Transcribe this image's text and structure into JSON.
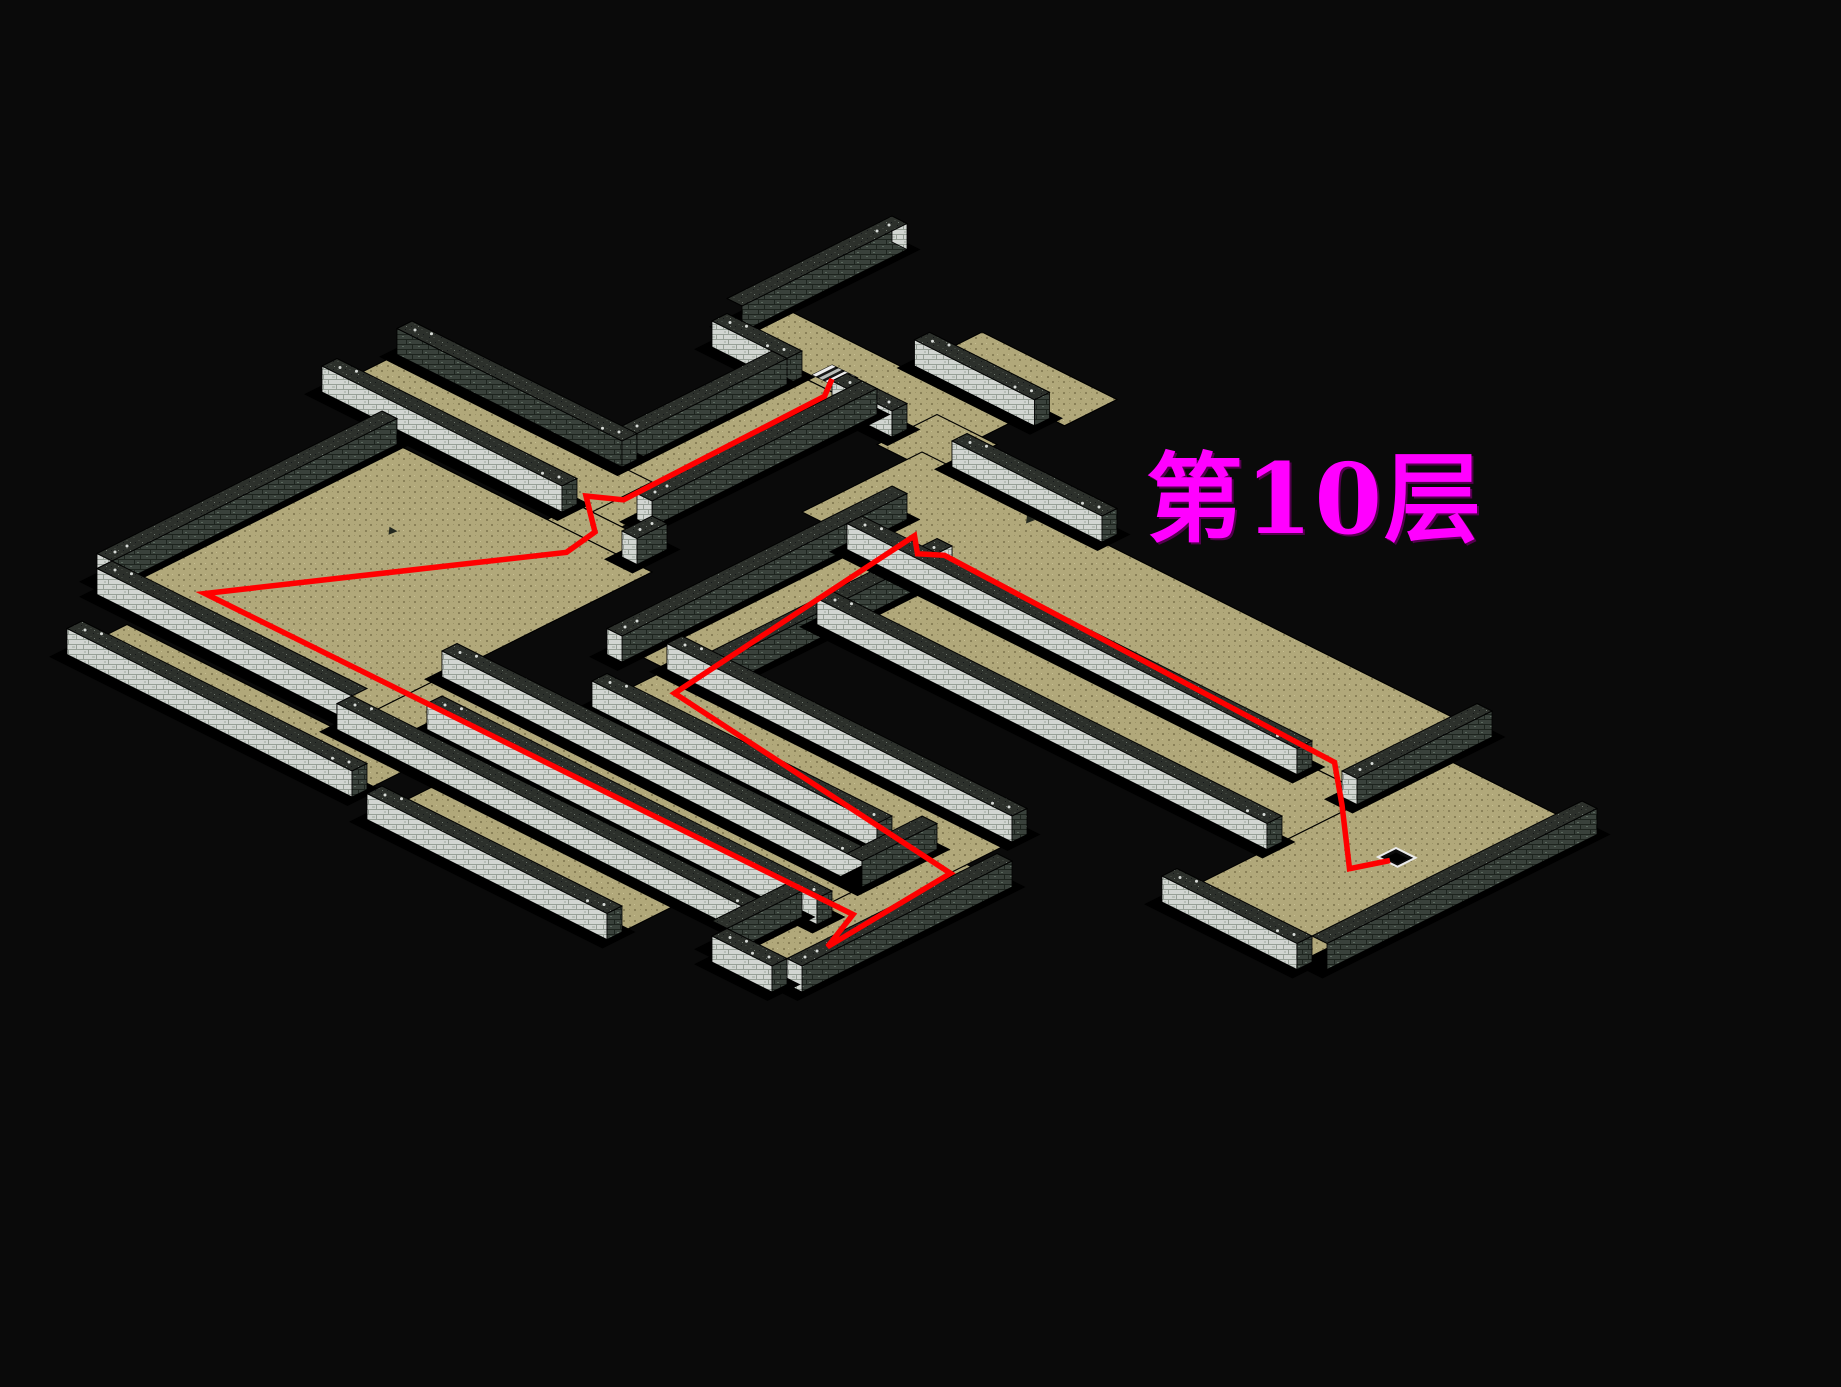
{
  "title": {
    "text": "第10层"
  },
  "colors": {
    "background": "#0a0a0a",
    "floor": "#b1a87a",
    "floorDot": "#8a8158",
    "floorDotLight": "#c8c093",
    "floorDotMid": "#9c9468",
    "wallLight": "#d2d6d2",
    "wallLightMortar": "#97a097",
    "wallLightSpeck": "#b8bfb8",
    "wallDark": "#39413b",
    "wallDarkMortar": "#1d241e",
    "wallDarkSpeck": "#5c6a5f",
    "wallTop": "#2c302b",
    "wallTopSpeck": "#3d423c",
    "wallTopSpeck2": "#15181a",
    "capDot": "#d8dcd8",
    "outline": "#000000",
    "shadow": "#000000",
    "path": "#ff0000",
    "title": "#ff00ff",
    "stairLight": "#ececec",
    "stairDark": "#161616",
    "marker": "#23281f"
  },
  "map": {
    "floors": [
      {
        "name": "corridor-top",
        "r": [
          8,
          23,
          5,
          9
        ]
      },
      {
        "name": "corridor-top-ne",
        "r": [
          16,
          25,
          0,
          3.5
        ]
      },
      {
        "name": "corridor-bend",
        "r": [
          20,
          24,
          7,
          11
        ]
      },
      {
        "name": "descender-1",
        "r": [
          13,
          17,
          9,
          25
        ]
      },
      {
        "name": "corridor-west",
        "r": [
          -2,
          15,
          21,
          25
        ]
      },
      {
        "name": "descender-2",
        "r": [
          14,
          19,
          25,
          27
        ]
      },
      {
        "name": "west-room",
        "r": [
          4,
          21,
          27,
          46
        ]
      },
      {
        "name": "south-corridor",
        "r": [
          21,
          53,
          41,
          47
        ]
      },
      {
        "name": "southwest-lane",
        "r": [
          7,
          26,
          48,
          51
        ]
      },
      {
        "name": "riser-corridor",
        "r": [
          49,
          53,
          36,
          50
        ]
      },
      {
        "name": "mid-corridor",
        "r": [
          28,
          51,
          33,
          37
        ]
      },
      {
        "name": "loop-west",
        "r": [
          26,
          30,
          15,
          33
        ]
      },
      {
        "name": "long-corridor",
        "r": [
          22,
          59,
          10,
          18
        ]
      },
      {
        "name": "long-lane-2",
        "r": [
          30,
          60,
          18,
          24
        ]
      },
      {
        "name": "east-room",
        "r": [
          60,
          69,
          13,
          31
        ]
      },
      {
        "name": "south-stub",
        "r": [
          28,
          44,
          48,
          52
        ]
      }
    ],
    "walls": [
      {
        "r": [
          7,
          8,
          -3,
          8
        ],
        "f": "dark",
        "caps": "n"
      },
      {
        "r": [
          16,
          24,
          3.5,
          4.5
        ],
        "f": "light",
        "caps": "we"
      },
      {
        "r": [
          8,
          13,
          9,
          10
        ],
        "f": "light",
        "caps": "we"
      },
      {
        "r": [
          16,
          20,
          9,
          10
        ],
        "f": "light",
        "caps": "we"
      },
      {
        "r": [
          24,
          34,
          9,
          10
        ],
        "f": "light",
        "caps": "we"
      },
      {
        "r": [
          12,
          13,
          10,
          21
        ],
        "f": "dark",
        "caps": "s"
      },
      {
        "r": [
          17,
          18,
          9,
          24
        ],
        "f": "dark",
        "caps": "s"
      },
      {
        "r": [
          -2,
          13,
          20,
          21
        ],
        "f": "dark",
        "caps": "we"
      },
      {
        "r": [
          -2,
          14,
          25,
          26
        ],
        "f": "light",
        "caps": "we"
      },
      {
        "r": [
          19,
          20,
          25,
          27
        ],
        "f": "dark",
        "caps": "s"
      },
      {
        "r": [
          3,
          4,
          27,
          46
        ],
        "f": "dark",
        "caps": "s"
      },
      {
        "r": [
          4,
          21,
          46,
          47
        ],
        "f": "light",
        "caps": "w"
      },
      {
        "r": [
          7,
          26,
          51,
          52
        ],
        "f": "light",
        "caps": "we"
      },
      {
        "r": [
          21,
          49,
          40,
          41
        ],
        "f": "light",
        "caps": "we"
      },
      {
        "r": [
          24,
          50,
          44,
          45
        ],
        "f": "light",
        "caps": "we"
      },
      {
        "r": [
          21,
          49,
          47,
          48
        ],
        "f": "light",
        "caps": "we"
      },
      {
        "r": [
          28,
          44,
          52,
          53
        ],
        "f": "light",
        "caps": "we"
      },
      {
        "r": [
          48,
          49,
          45,
          50
        ],
        "f": "dark",
        "caps": ""
      },
      {
        "r": [
          53,
          54,
          36,
          50
        ],
        "f": "dark",
        "caps": "s"
      },
      {
        "r": [
          48,
          49,
          36,
          41
        ],
        "f": "dark",
        "caps": ""
      },
      {
        "r": [
          49,
          53,
          50,
          51
        ],
        "f": "light",
        "caps": "we"
      },
      {
        "r": [
          28,
          51,
          32,
          33
        ],
        "f": "light",
        "caps": "we"
      },
      {
        "r": [
          28,
          47,
          37,
          38
        ],
        "f": "light",
        "caps": "we"
      },
      {
        "r": [
          25,
          26,
          15,
          34
        ],
        "f": "dark",
        "caps": "s"
      },
      {
        "r": [
          30,
          31,
          17,
          33
        ],
        "f": "dark",
        "caps": "n"
      },
      {
        "r": [
          26,
          56,
          18,
          19
        ],
        "f": "light",
        "caps": "we"
      },
      {
        "r": [
          30,
          60,
          24,
          25
        ],
        "f": "light",
        "caps": "we"
      },
      {
        "r": [
          59,
          60,
          10,
          19
        ],
        "f": "dark",
        "caps": "s"
      },
      {
        "r": [
          69,
          70,
          13,
          31
        ],
        "f": "dark",
        "caps": ""
      },
      {
        "r": [
          60,
          69,
          31,
          32
        ],
        "f": "light",
        "caps": "we"
      }
    ],
    "path": [
      [
        14.2,
        8.2
      ],
      [
        15.1,
        9.6
      ],
      [
        15.3,
        23.2
      ],
      [
        13.8,
        24.2
      ],
      [
        16.5,
        26.3
      ],
      [
        16.9,
        28.6
      ],
      [
        7.6,
        43.4
      ],
      [
        50.6,
        43.2
      ],
      [
        51.9,
        46.2
      ],
      [
        51.1,
        37.2
      ],
      [
        29.9,
        34.4
      ],
      [
        27.4,
        15.9
      ],
      [
        28.7,
        17.0
      ],
      [
        29.7,
        16.2
      ],
      [
        56.5,
        17.0
      ],
      [
        59.6,
        19.6
      ],
      [
        64.1,
        23.6
      ],
      [
        64.9,
        21.7
      ]
    ],
    "stairs": [
      {
        "name": "stairs-entry",
        "type": "up",
        "u": 13.2,
        "v": 7.2,
        "du": 1.7,
        "dv": 1.3
      },
      {
        "name": "stairs-exit",
        "type": "down",
        "u": 64.2,
        "v": 20.6,
        "du": 1.3,
        "dv": 1.2
      }
    ],
    "markers": [
      [
        30,
        11
      ],
      [
        9.5,
        33
      ]
    ]
  }
}
